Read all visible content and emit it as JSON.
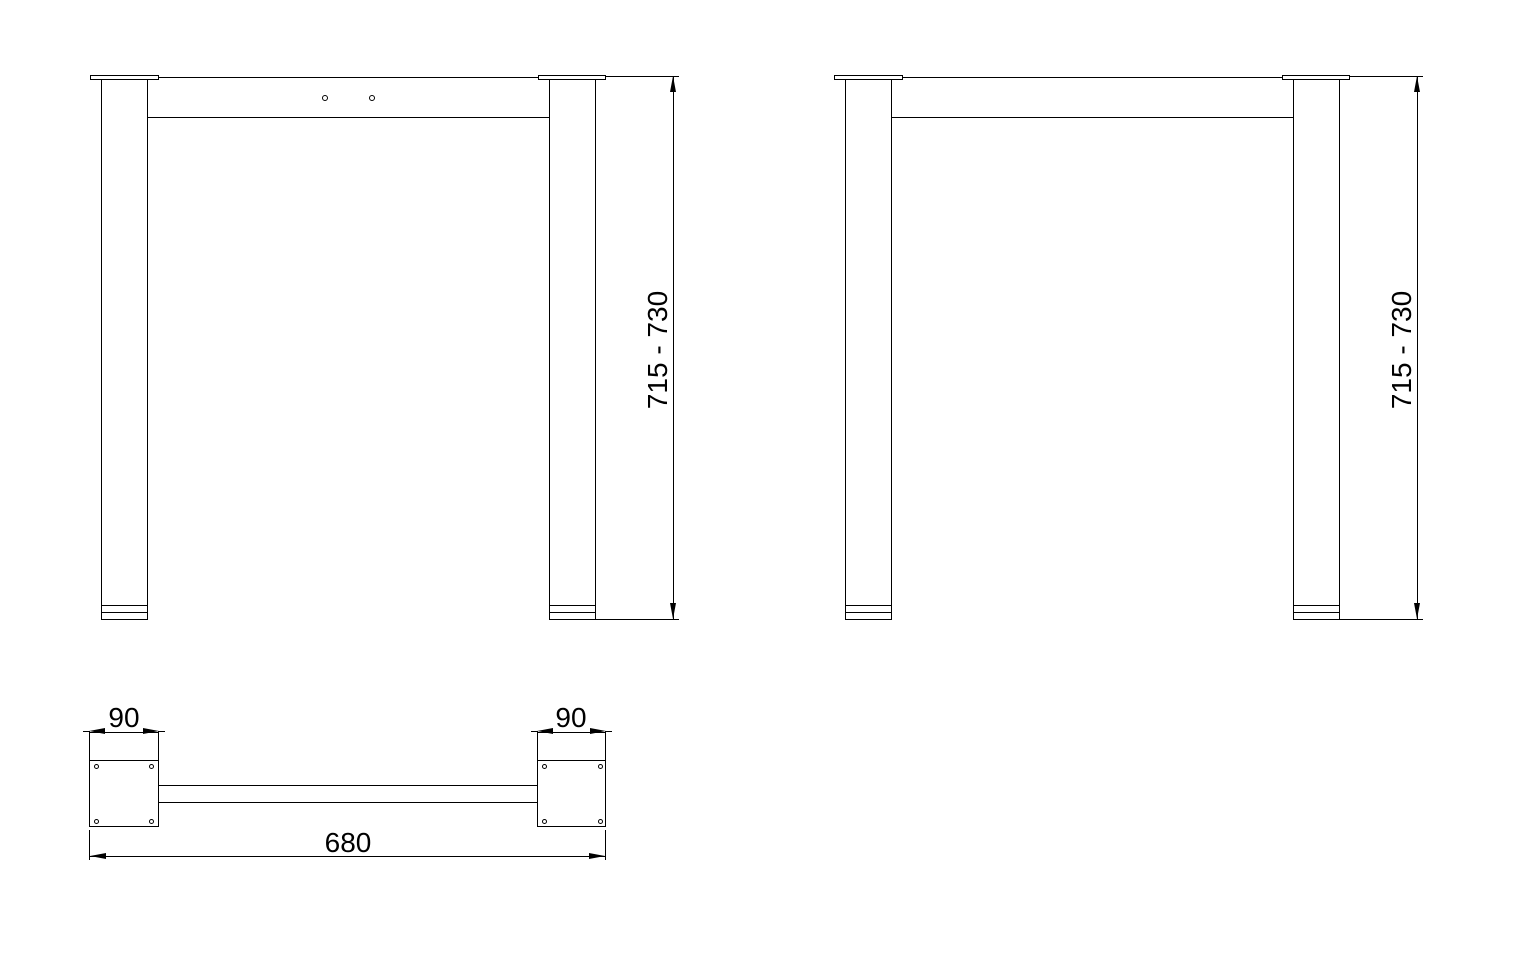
{
  "drawing": {
    "front_view_left": {
      "height_dimension": "715 - 730"
    },
    "front_view_right": {
      "height_dimension": "715 - 730"
    },
    "bottom_view": {
      "left_plate_width": "90",
      "right_plate_width": "90",
      "overall_length": "680"
    },
    "colors": {
      "line": "#000000",
      "background": "#ffffff"
    }
  }
}
